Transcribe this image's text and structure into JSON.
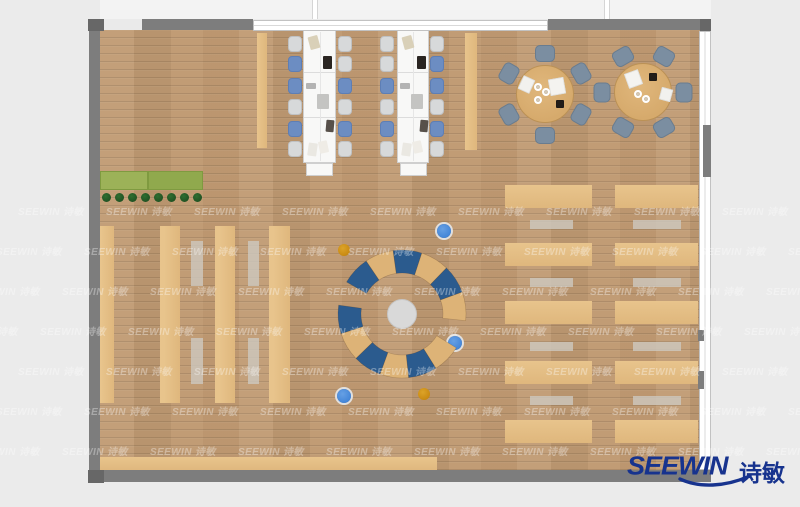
{
  "brand": {
    "logo_text": "SEEWIN",
    "logo_text_cn": "诗敏",
    "logo_color": "#17338e"
  },
  "watermark": {
    "text": "SEEWIN 诗敏",
    "grid": {
      "x0": 18,
      "y0": 203,
      "dx": 88,
      "dy": 40,
      "cols": 10,
      "rows": 7,
      "row_shift": 22
    }
  },
  "palette": {
    "floor": "#c09a72",
    "wall": "#7d7d7d",
    "wall_dark": "#676767",
    "desk_white": "#f8f8f7",
    "chair_light": "#d7d9da",
    "chair_light_border": "#bfc1c3",
    "chair_blue": "#6c8dc2",
    "chair_blue_border": "#5d7eb5",
    "table_wood": "#d6aa6c",
    "table_wood_border": "#bb9155",
    "chair_slate": "#7b8ea1",
    "chair_slate_border": "#697c8f",
    "bench_tan": "#dfb77d",
    "bench_tan_light": "#e8c48c",
    "mat_gray": "#cdc8bf",
    "planter_green_a": "#9cb258",
    "planter_green_b": "#90a94d",
    "plant_dark": "#215323",
    "arc_blue": "#2b5b8e",
    "arc_tan": "#ddb377",
    "dot_blue": "#4486d8",
    "dot_orange": "#c98a12",
    "hub_gray": "#d9d9d9"
  },
  "plan": {
    "pillar_strips": [
      {
        "id": "pillar-strip-left-of-desks",
        "x": 257,
        "y": 33,
        "w": 10,
        "h": 115
      },
      {
        "id": "pillar-strip-right-of-desks",
        "x": 465,
        "y": 33,
        "w": 12,
        "h": 117
      }
    ],
    "bottom_bench": {
      "x": 100,
      "y": 457,
      "w": 337,
      "h": 14
    },
    "shelves": [
      {
        "x": 98,
        "y": 226,
        "w": 16,
        "h": 177
      },
      {
        "x": 160,
        "y": 226,
        "w": 20,
        "h": 177
      },
      {
        "x": 215,
        "y": 226,
        "w": 20,
        "h": 177
      },
      {
        "x": 269,
        "y": 226,
        "w": 21,
        "h": 177
      }
    ],
    "shelf_mats": [
      {
        "x": 191,
        "y": 241,
        "w": 12,
        "h": 45
      },
      {
        "x": 191,
        "y": 338,
        "w": 12,
        "h": 46
      },
      {
        "x": 248,
        "y": 241,
        "w": 11,
        "h": 45
      },
      {
        "x": 248,
        "y": 338,
        "w": 11,
        "h": 46
      }
    ],
    "bench_columns": [
      {
        "x": 505,
        "w": 87,
        "mat_x": 530,
        "mat_w": 43
      },
      {
        "x": 615,
        "w": 83,
        "mat_x": 633,
        "mat_w": 48
      }
    ],
    "bench_row_y": [
      185,
      243,
      301,
      361,
      420
    ],
    "bench_row_h": 23,
    "bench_mat_y": [
      220,
      278,
      342,
      396
    ],
    "bench_mat_h": 9,
    "planter": {
      "x": 100,
      "y": 171,
      "w": 103,
      "h": 19,
      "split": 48,
      "plant_x0": 106,
      "plant_dx": 13,
      "plant_count": 8,
      "plant_y": 197,
      "plant_r": 4.5
    },
    "desks": [
      {
        "x": 303,
        "y": 30,
        "w": 33,
        "h": 133,
        "end_table": {
          "x": 306,
          "y": 163,
          "w": 27,
          "h": 13
        },
        "chairs_left_x": 288,
        "chairs_right_x": 338,
        "chairs_left": [
          "L",
          "B",
          "B",
          "L",
          "B",
          "L"
        ],
        "chairs_right": [
          "L",
          "L",
          "B",
          "L",
          "B",
          "L"
        ]
      },
      {
        "x": 397,
        "y": 30,
        "w": 32,
        "h": 133,
        "end_table": {
          "x": 400,
          "y": 163,
          "w": 27,
          "h": 13
        },
        "chairs_left_x": 380,
        "chairs_right_x": 430,
        "chairs_left": [
          "L",
          "L",
          "B",
          "L",
          "B",
          "L"
        ],
        "chairs_right": [
          "L",
          "B",
          "B",
          "L",
          "B",
          "L"
        ]
      }
    ],
    "desk_chair_rows_y": [
      36,
      56,
      78,
      99,
      121,
      141
    ],
    "desk_chair_size": {
      "w": 14,
      "h": 16
    },
    "desk_module_offsets": [
      42,
      87
    ],
    "desk_items": [
      {
        "dx": 6,
        "y": 36,
        "w": 10,
        "h": 13,
        "rot": -15,
        "c": "#d9d0b8"
      },
      {
        "dx": 20,
        "y": 56,
        "w": 9,
        "h": 13,
        "rot": 0,
        "c": "#2a2522"
      },
      {
        "dx": 3,
        "y": 83,
        "w": 10,
        "h": 6,
        "rot": 0,
        "c": "#b3b3b3"
      },
      {
        "dx": 14,
        "y": 94,
        "w": 12,
        "h": 15,
        "rot": 0,
        "c": "#c4c4c2"
      },
      {
        "dx": 23,
        "y": 120,
        "w": 8,
        "h": 12,
        "rot": 5,
        "c": "#57504a"
      },
      {
        "dx": 5,
        "y": 143,
        "w": 9,
        "h": 13,
        "rot": 8,
        "c": "#eae8e2"
      },
      {
        "dx": 16,
        "y": 141,
        "w": 9,
        "h": 12,
        "rot": -12,
        "c": "#efece6"
      }
    ],
    "window_caps": [
      {
        "x": 300,
        "w": 37
      },
      {
        "x": 393,
        "w": 37
      }
    ],
    "round_tables": [
      {
        "cx": 545,
        "cy": 94,
        "r": 29,
        "chair_angles": [
          90,
          150,
          210,
          270,
          30,
          330
        ],
        "items": [
          {
            "x": 520,
            "y": 77,
            "w": 13,
            "h": 15,
            "rot": 25,
            "c": "#f2f1ee"
          },
          {
            "x": 549,
            "y": 78,
            "w": 16,
            "h": 17,
            "rot": -10,
            "c": "#f4f3f0"
          },
          {
            "x": 556,
            "y": 100,
            "w": 8,
            "h": 8,
            "rot": 0,
            "c": "#221d18"
          }
        ],
        "plates": [
          {
            "x": 538,
            "y": 87
          },
          {
            "x": 546,
            "y": 92
          },
          {
            "x": 538,
            "y": 100
          }
        ]
      },
      {
        "cx": 643,
        "cy": 92,
        "r": 29,
        "chair_angles": [
          0,
          60,
          120,
          180,
          240,
          300
        ],
        "items": [
          {
            "x": 626,
            "y": 71,
            "w": 15,
            "h": 16,
            "rot": -20,
            "c": "#f4f3f0"
          },
          {
            "x": 649,
            "y": 73,
            "w": 8,
            "h": 8,
            "rot": 0,
            "c": "#221d18"
          },
          {
            "x": 660,
            "y": 88,
            "w": 12,
            "h": 13,
            "rot": 15,
            "c": "#f2f1ee"
          }
        ],
        "plates": [
          {
            "x": 638,
            "y": 94
          },
          {
            "x": 646,
            "y": 99
          }
        ]
      }
    ],
    "chair_slate_size": {
      "w": 20,
      "h": 17,
      "dist": 41
    },
    "ring": {
      "cx": 402,
      "cy": 314,
      "r_in": 41,
      "r_out": 64,
      "hub_r": 15,
      "arcs": [
        {
          "a1": 150,
          "a2": -6,
          "segments": [
            "blue",
            "tan",
            "blue",
            "tan",
            "blue",
            "tan"
          ]
        },
        {
          "a1": 172,
          "a2": 328,
          "segments": [
            "blue",
            "tan",
            "blue",
            "tan",
            "blue",
            "tan"
          ]
        }
      ]
    },
    "dots": [
      {
        "x": 344,
        "y": 250,
        "color": "orange"
      },
      {
        "x": 444,
        "y": 231,
        "color": "blue"
      },
      {
        "x": 455,
        "y": 343,
        "color": "blue"
      },
      {
        "x": 424,
        "y": 394,
        "color": "orange"
      },
      {
        "x": 344,
        "y": 396,
        "color": "blue"
      }
    ]
  }
}
